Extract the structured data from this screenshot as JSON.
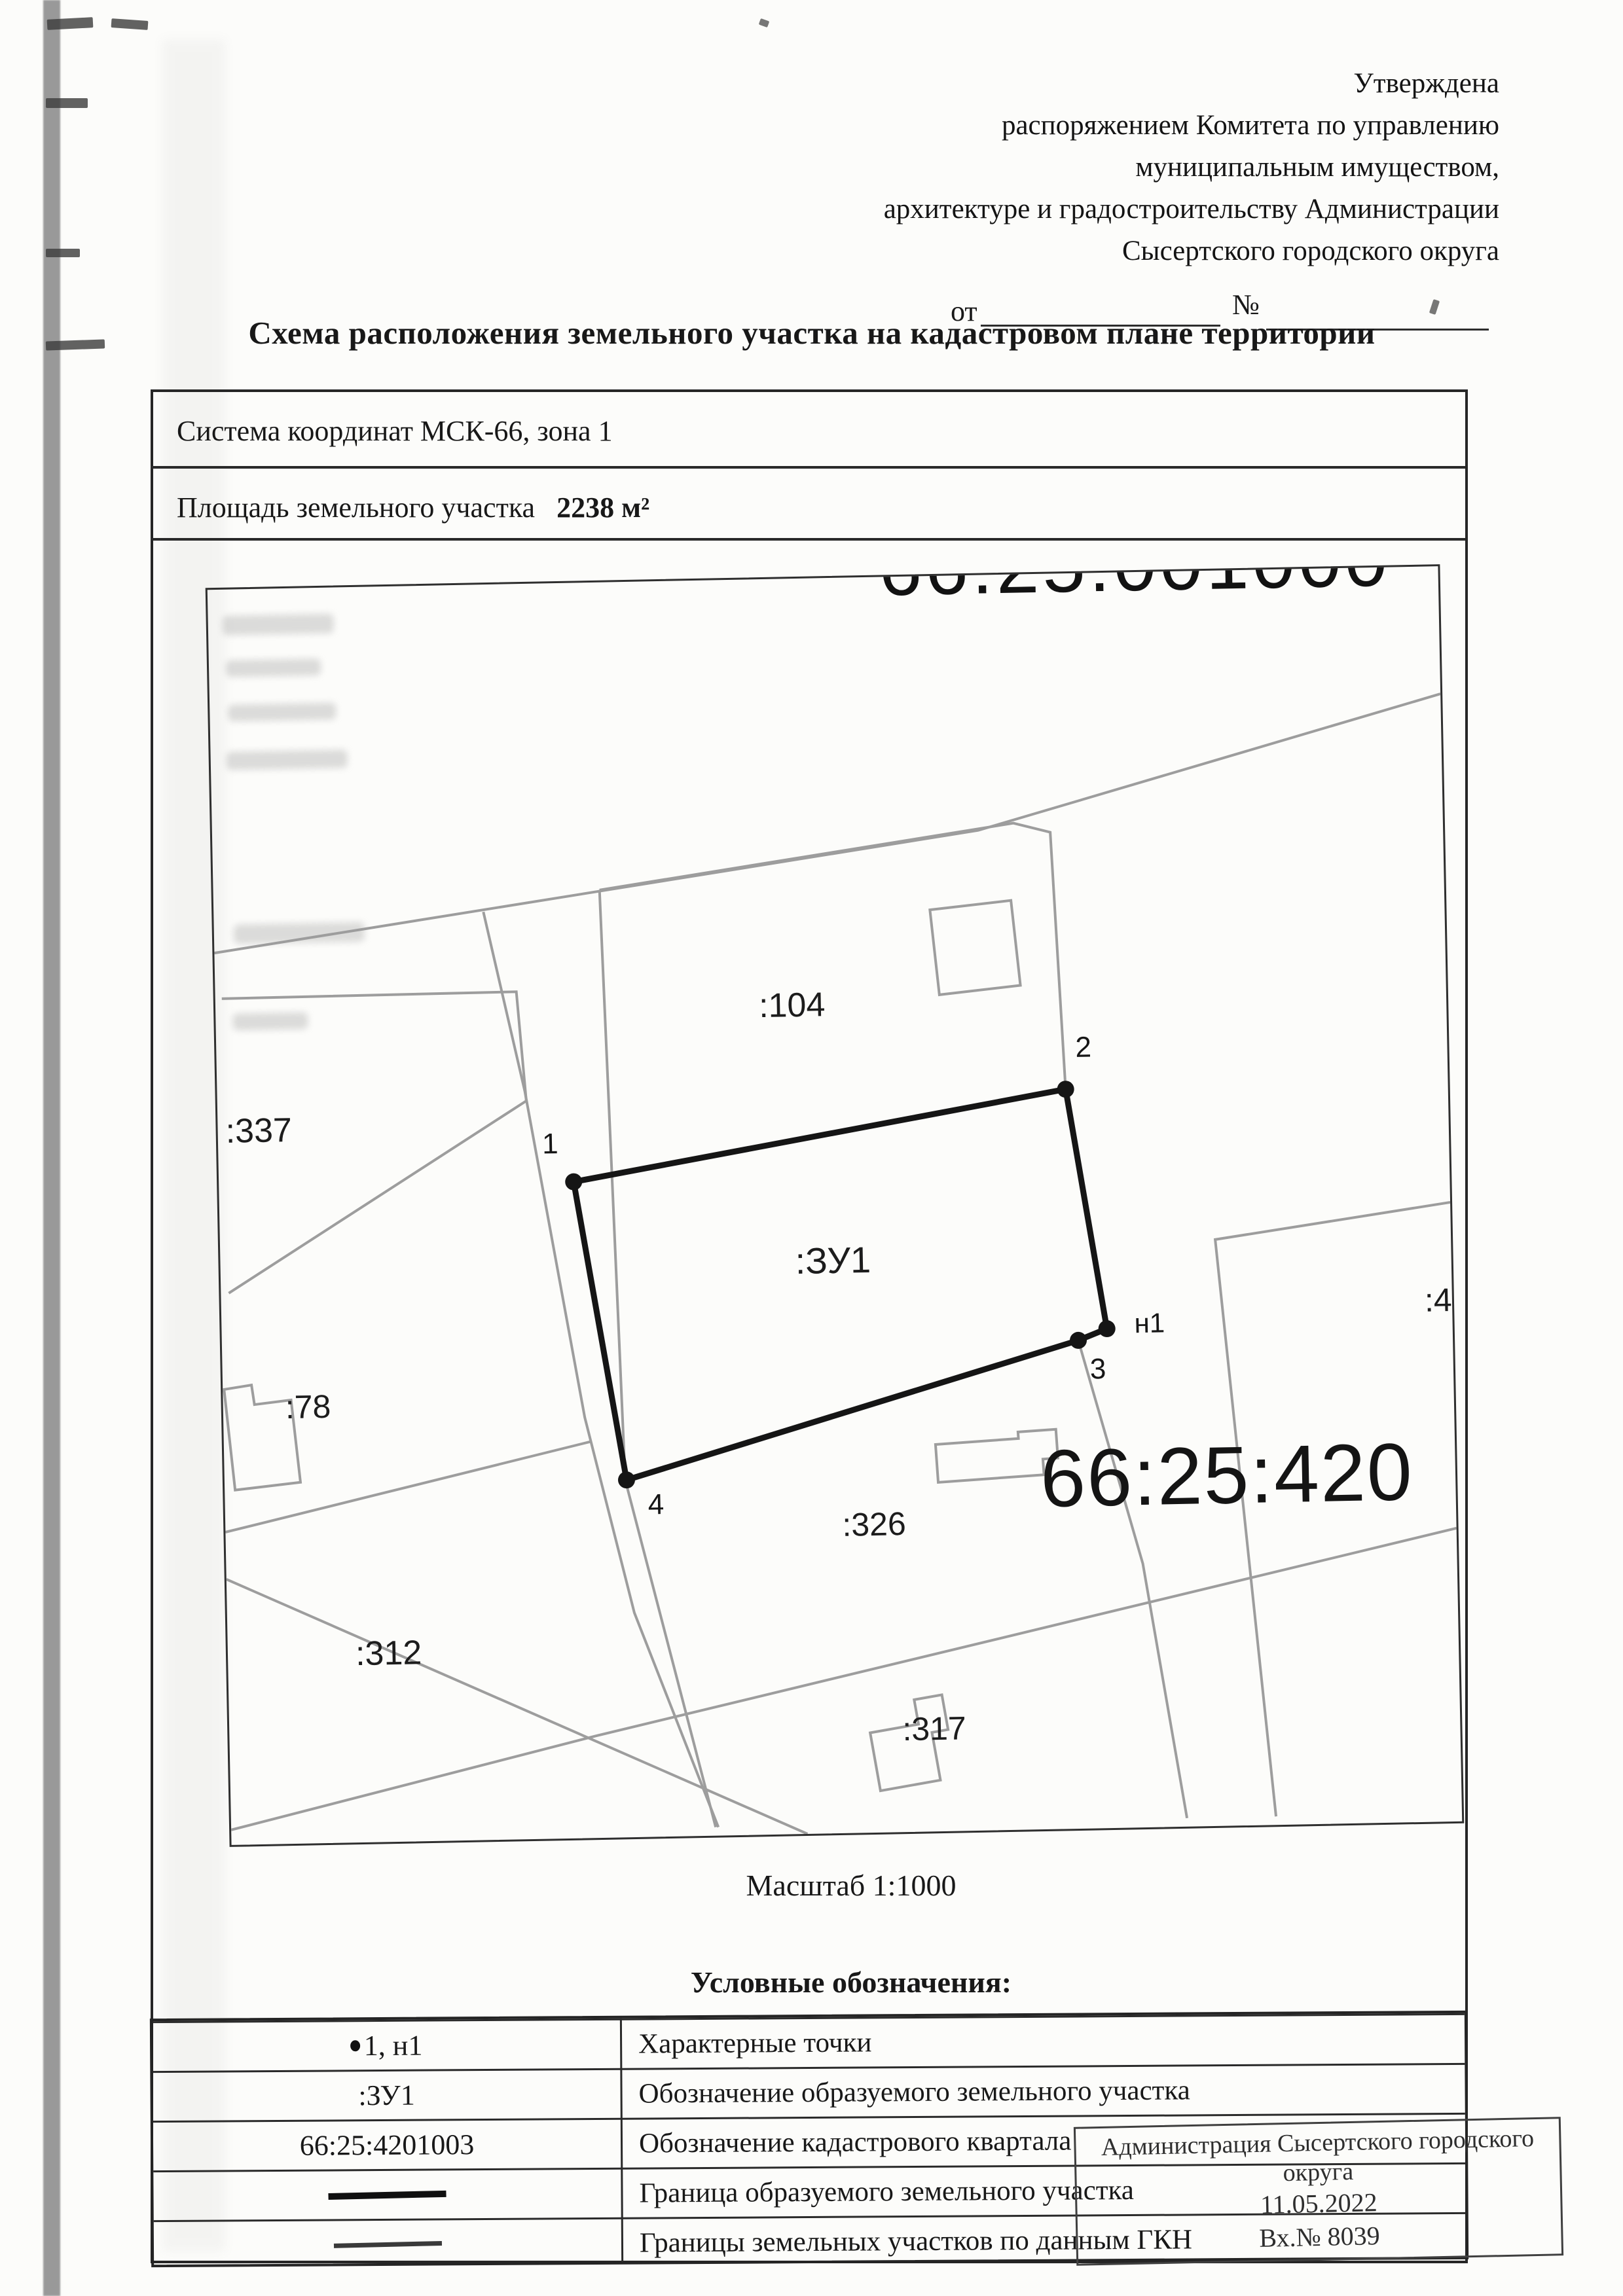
{
  "approval": {
    "lines": [
      "Утверждена",
      "распоряжением Комитета по управлению",
      "муниципальным имуществом,",
      "архитектуре и градостроительству Администрации",
      "Сысертского городского округа"
    ],
    "from_label": "от",
    "number_label": "№"
  },
  "title": "Схема расположения земельного участка на кадастровом плане территории",
  "info_table": {
    "coordinate_system": "Система координат МСК-66, зона 1",
    "area_label": "Площадь земельного участка",
    "area_value": "2238 м²"
  },
  "map": {
    "clipped_quarter_top": "66:25:001000",
    "quarter_number": "66:25:420",
    "subject_parcel": ":ЗУ1",
    "parcels": [
      ":104",
      ":337",
      ":78",
      ":312",
      ":326",
      ":317"
    ],
    "clipped_parcel_right": ":49",
    "points": [
      "1",
      "2",
      "н1",
      "3",
      "4"
    ]
  },
  "scale_caption": "Масштаб 1:1000",
  "legend": {
    "heading": "Условные обозначения:",
    "rows": [
      {
        "symbol_text": "1, н1",
        "description": "Характерные точки"
      },
      {
        "symbol_text": ":ЗУ1",
        "description": "Обозначение образуемого земельного участка"
      },
      {
        "symbol_text": "66:25:4201003",
        "description": "Обозначение кадастрового квартала"
      },
      {
        "symbol_text": "",
        "description": "Граница образуемого земельного участка"
      },
      {
        "symbol_text": "",
        "description": "Границы земельных участков по данным ГКН"
      }
    ]
  },
  "stamp": {
    "lines": [
      "Администрация Сысертского городского",
      "округа",
      "11.05.2022",
      "Вх.№ 8039"
    ]
  }
}
